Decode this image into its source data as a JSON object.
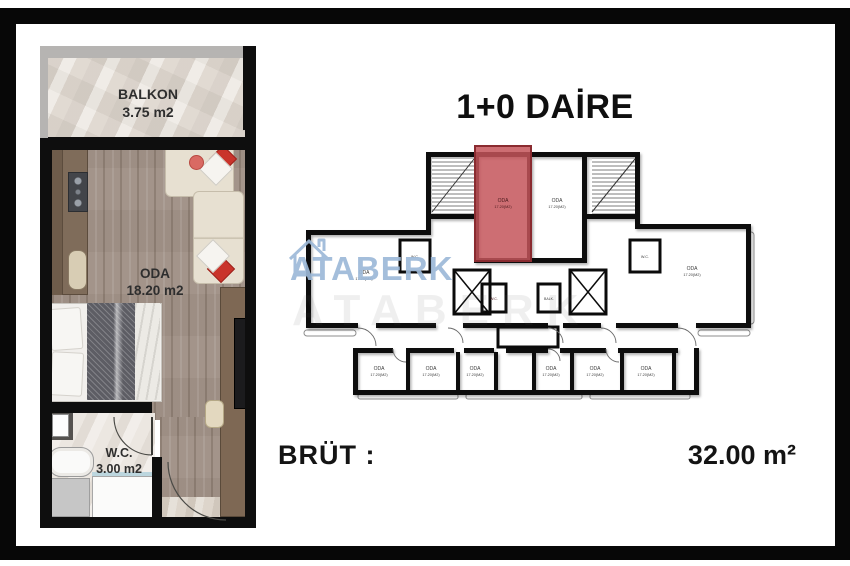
{
  "title": "1+0 DAİRE",
  "gross_area": {
    "label": "BRÜT :",
    "value": "32.00 m²"
  },
  "watermark": {
    "brand": "ATABERK",
    "echo": "ATABERK"
  },
  "unit_plan": {
    "balcony": {
      "name": "BALKON",
      "area": "3.75 m2"
    },
    "room": {
      "name": "ODA",
      "area": "18.20 m2"
    },
    "wc": {
      "name": "W.C.",
      "area": "3.00 m2"
    }
  },
  "key_plan": {
    "highlight_color": "#c4555b",
    "room_label": "ODA",
    "room_area_label": "17.20(M2)",
    "wc_label": "W.C.",
    "balcony_label": "BALK."
  },
  "colors": {
    "frame_black": "#070707",
    "highlight_red": "#c4555b",
    "watermark_blue": "#9db9d8"
  }
}
